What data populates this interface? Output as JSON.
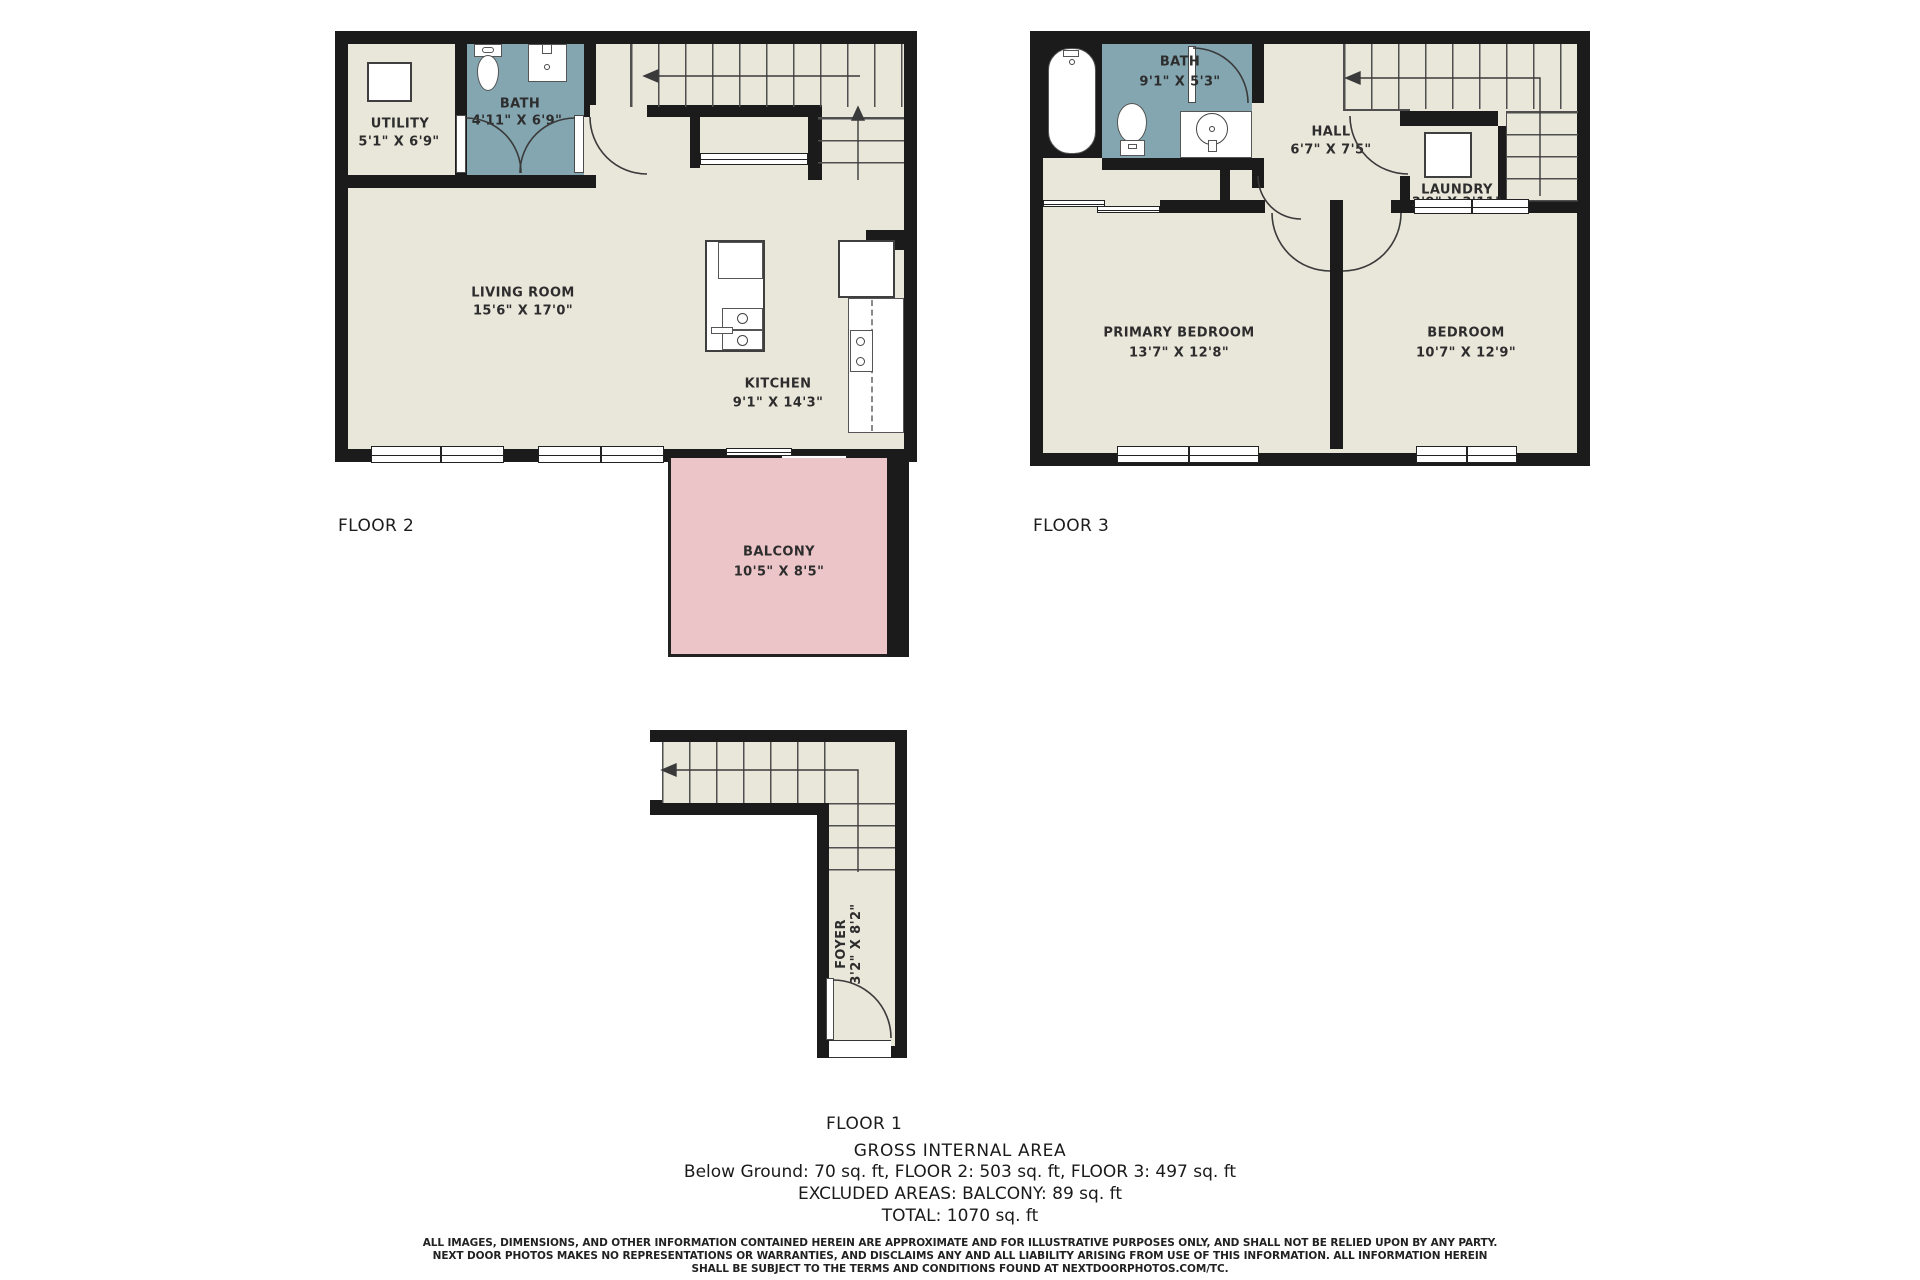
{
  "floors": {
    "floor2": {
      "label": "FLOOR 2",
      "rooms": {
        "utility": {
          "name": "UTILITY",
          "dims": "5'1\" X 6'9\""
        },
        "bath": {
          "name": "BATH",
          "dims": "4'11\" X 6'9\""
        },
        "living": {
          "name": "LIVING ROOM",
          "dims": "15'6\" X 17'0\""
        },
        "kitchen": {
          "name": "KITCHEN",
          "dims": "9'1\" X 14'3\""
        },
        "balcony": {
          "name": "BALCONY",
          "dims": "10'5\" X 8'5\""
        }
      }
    },
    "floor3": {
      "label": "FLOOR 3",
      "rooms": {
        "bath": {
          "name": "BATH",
          "dims": "9'1\" X 5'3\""
        },
        "hall": {
          "name": "HALL",
          "dims": "6'7\" X 7'5\""
        },
        "laundry": {
          "name": "LAUNDRY",
          "dims": "3'9\" X 3'11\""
        },
        "primary": {
          "name": "PRIMARY BEDROOM",
          "dims": "13'7\" X 12'8\""
        },
        "bedroom": {
          "name": "BEDROOM",
          "dims": "10'7\" X 12'9\""
        }
      }
    },
    "floor1": {
      "label": "FLOOR 1",
      "rooms": {
        "foyer": {
          "name": "FOYER",
          "dims": "3'2\" X 8'2\""
        }
      }
    }
  },
  "summary": {
    "title": "GROSS INTERNAL AREA",
    "line1": "Below Ground: 70 sq. ft, FLOOR 2: 503 sq. ft, FLOOR 3: 497 sq. ft",
    "line2": "EXCLUDED AREAS: BALCONY: 89 sq. ft",
    "line3": "TOTAL: 1070 sq. ft"
  },
  "disclaimer": {
    "line1": "ALL IMAGES, DIMENSIONS, AND OTHER INFORMATION CONTAINED HEREIN ARE APPROXIMATE AND FOR ILLUSTRATIVE PURPOSES ONLY, AND SHALL NOT BE RELIED UPON BY ANY PARTY.",
    "line2": "NEXT DOOR PHOTOS MAKES NO REPRESENTATIONS OR WARRANTIES, AND DISCLAIMS ANY AND ALL LIABILITY ARISING FROM USE OF THIS INFORMATION. ALL INFORMATION HEREIN",
    "line3": "SHALL BE SUBJECT TO THE TERMS AND CONDITIONS FOUND AT NEXTDOORPHOTOS.COM/TC."
  },
  "colors": {
    "wall": "#1b1b1b",
    "floor": "#e9e6da",
    "bath_teal": "#83a6b0",
    "balcony_pink": "#ecc5c8",
    "background": "#ffffff"
  }
}
